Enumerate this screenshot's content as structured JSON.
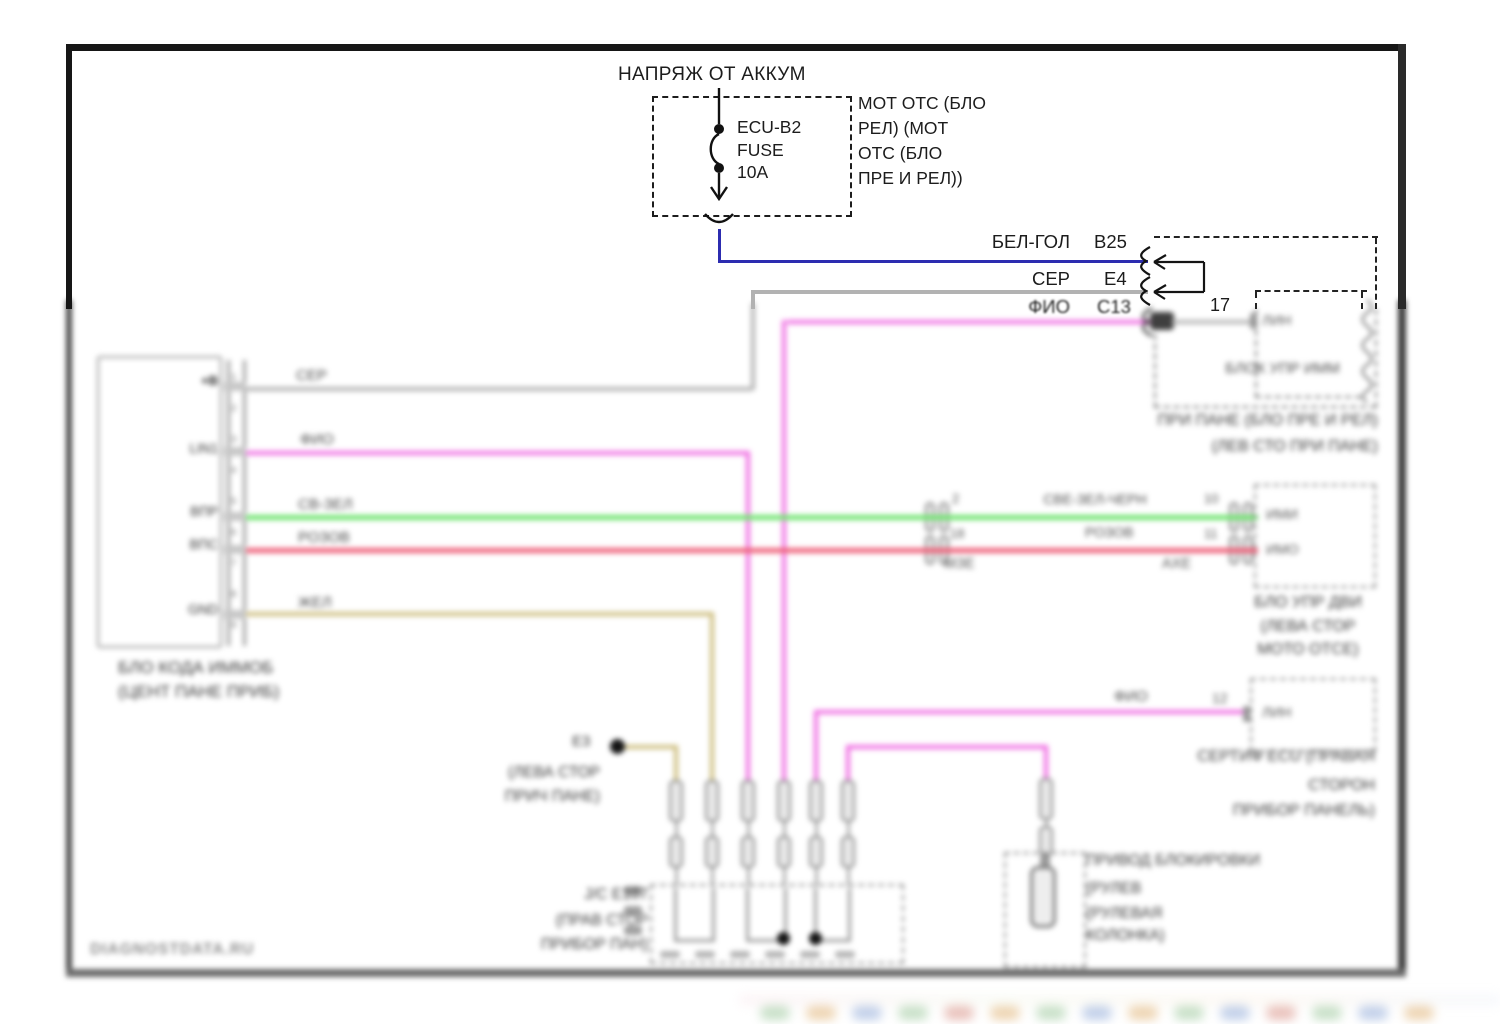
{
  "colors": {
    "wire_blue": "#2c2cb0",
    "wire_gray": "#b2b2b2",
    "wire_violet": "#ef6ce2",
    "wire_green": "#6fe46f",
    "wire_pink": "#ee5f78",
    "wire_tan": "#cdbd7e",
    "frame": "#161616"
  },
  "top": {
    "title": "НАПРЯЖ ОТ АККУМ",
    "fuse_lines": [
      "ECU-B2",
      "FUSE",
      "10A"
    ],
    "note_lines": [
      "МОТ ОТС (БЛО",
      "РЕЛ) (МОТ",
      "ОТС (БЛО",
      "ПРЕ И РЕЛ))"
    ],
    "row1_wire": "БЕЛ-ГОЛ",
    "row1_pin": "B25",
    "row2_wire": "СЕР",
    "row2_pin": "E4",
    "row3_wire": "ФИО",
    "row3_pin": "C13",
    "pin_17": "17"
  },
  "immobilizer_box": {
    "name": "БЛОК УПР ИММ",
    "pin_label": "ЛИН",
    "caption_lines": [
      "ПРИ ПАНЕ (БЛО ПРЕ И РЕЛ)",
      "(ЛЕВ СТО ПРИ ПАНЕ)"
    ]
  },
  "left_unit": {
    "pin_numbers": "1\n2\n3\n4\n5\n6\n7\n8\n9",
    "pin_labels": [
      "+B",
      "LIN1",
      "ВПР",
      "ВПС",
      "GND"
    ],
    "caption_lines": [
      "БЛО КОДА ИММОБ",
      "(ЦЕНТ ПАНЕ ПРИБ)"
    ]
  },
  "wire_labels": {
    "gray": "СЕР",
    "violet": "ФИО",
    "green": "СВ-ЗЕЛ",
    "pink": "РОЗОВ",
    "tan": "ЖЕЛ"
  },
  "mid_connector": {
    "green_label": "СВЕ-ЗЕЛ-ЧЕРН",
    "pink_label": "РОЗОВ",
    "left_pin_top": "2",
    "left_pin_bottom": "18",
    "right_pin_top": "10",
    "right_pin_bottom": "11",
    "left_tag": "МЗЕ",
    "right_tag": "АХЕ"
  },
  "engine_ecu": {
    "pin_top": "ИМИ",
    "pin_bottom": "ИМО",
    "caption_lines": [
      "БЛО УПР ДВИ",
      "(ЛЕВА СТОР",
      "МОТО ОТСЕ)"
    ]
  },
  "cert_ecu": {
    "wire_label": "ФИО",
    "pin_number": "12",
    "pin_label": "ЛИН",
    "caption_lines": [
      "СЕРТИФ ECU (ПРАВАЯ",
      "СТОРОН",
      "ПРИБОР ПАНЕЛЬ)"
    ]
  },
  "steering_lock": {
    "caption_lines": [
      "ПРИВОД БЛОКИРОВКИ",
      "(РУЛЕВ",
      "(РУЛЕВАЯ",
      "КОЛОНКА)"
    ]
  },
  "ground_point": {
    "label": "E3",
    "caption_lines": [
      "(ЛЕВА СТОР",
      "ПРИЧ ПАНЕ)"
    ]
  },
  "junction": {
    "caption_lines": [
      "J/C E107",
      "(ПРАВ СТОР",
      "ПРИБОР ПАН)"
    ]
  },
  "watermark": "DIAGNOSTDATA.RU"
}
